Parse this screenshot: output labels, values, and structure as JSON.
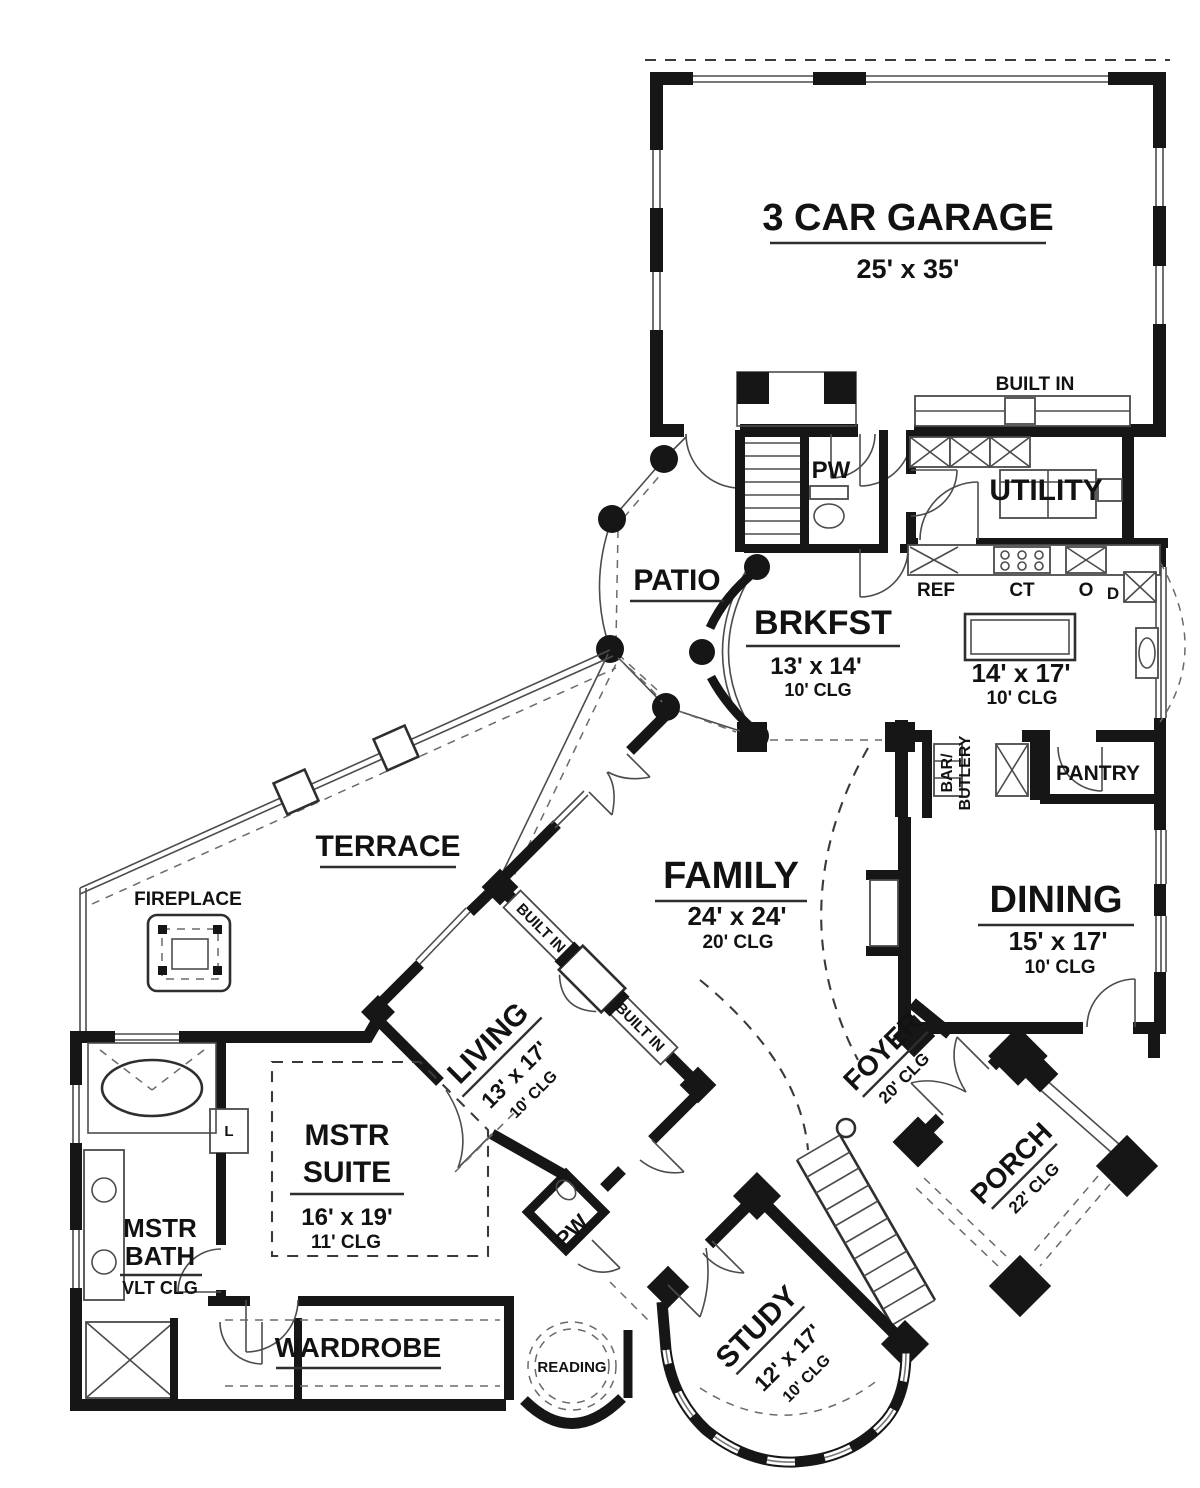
{
  "rooms": {
    "garage": {
      "name": "3 CAR GARAGE",
      "dims": "25' x 35'"
    },
    "built_in_garage": {
      "name": "BUILT IN"
    },
    "pw_upper": {
      "name": "PW"
    },
    "utility": {
      "name": "UTILITY"
    },
    "patio": {
      "name": "PATIO"
    },
    "brkfst": {
      "name": "BRKFST",
      "dims": "13' x 14'",
      "clg": "10' CLG"
    },
    "kitchen": {
      "dims": "14' x 17'",
      "clg": "10' CLG"
    },
    "pantry": {
      "name": "PANTRY"
    },
    "bar": {
      "line1": "BAR/",
      "line2": "BUTLERY"
    },
    "terrace": {
      "name": "TERRACE"
    },
    "fireplace": {
      "name": "FIREPLACE"
    },
    "family": {
      "name": "FAMILY",
      "dims": "24' x 24'",
      "clg": "20' CLG"
    },
    "dining": {
      "name": "DINING",
      "dims": "15' x 17'",
      "clg": "10' CLG"
    },
    "living": {
      "name": "LIVING",
      "dims": "13' x 17'",
      "clg": "10' CLG"
    },
    "built_in_upper": {
      "name": "BUILT IN"
    },
    "built_in_lower": {
      "name": "BUILT IN"
    },
    "foyer": {
      "name": "FOYER",
      "clg": "20' CLG"
    },
    "porch": {
      "name": "PORCH",
      "clg": "22' CLG"
    },
    "mstr_suite": {
      "line1": "MSTR",
      "line2": "SUITE",
      "dims": "16' x 19'",
      "clg": "11' CLG"
    },
    "mstr_bath": {
      "line1": "MSTR",
      "line2": "BATH",
      "clg": "VLT CLG"
    },
    "pw_lower": {
      "name": "PW"
    },
    "wardrobe": {
      "name": "WARDROBE"
    },
    "reading": {
      "name": "READING"
    },
    "study": {
      "name": "STUDY",
      "dims": "12' x 17'",
      "clg": "10' CLG"
    },
    "linen": {
      "name": "L"
    }
  },
  "appliances": {
    "ref": "REF",
    "ct": "CT",
    "oven": "O",
    "dw": "D"
  },
  "colors": {
    "wall": "#161616",
    "background": "#ffffff"
  }
}
